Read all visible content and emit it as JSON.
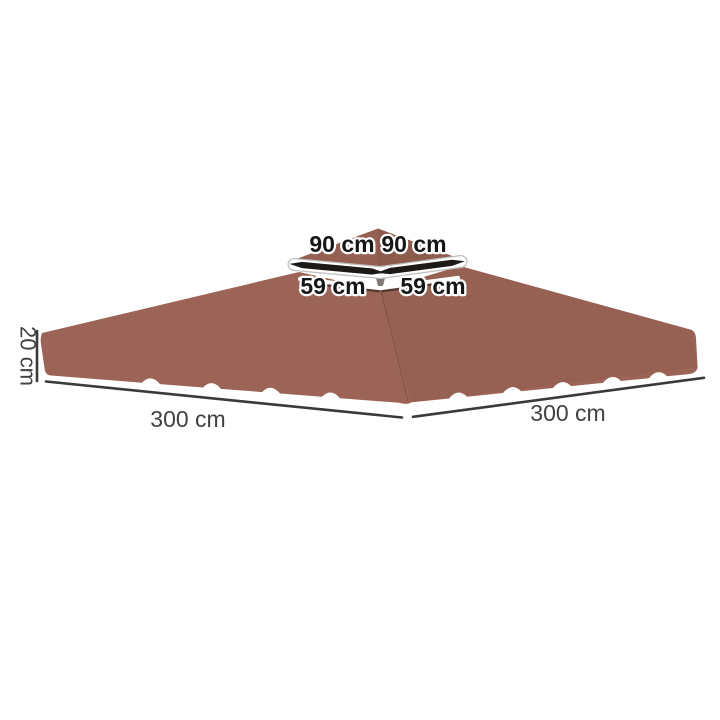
{
  "diagram": {
    "type": "product-dimension-diagram",
    "subject": "two-tier gazebo canopy replacement top",
    "labels": {
      "top_tier_left": "90 cm",
      "top_tier_right": "90 cm",
      "vent_left": "59 cm",
      "vent_right": "59 cm",
      "edge_height": "20 cm",
      "base_left": "300 cm",
      "base_right": "300 cm"
    },
    "colors": {
      "background": "#ffffff",
      "canopy": "#9c6456",
      "canopy_top_tier": "#956051",
      "trim_white": "#ffffff",
      "arrow_black": "#1c1917",
      "dimension_line": "#3a3a3a",
      "dimension_text": "#414141",
      "outlined_text_fill": "#161616",
      "outlined_text_stroke": "#ffffff"
    }
  }
}
